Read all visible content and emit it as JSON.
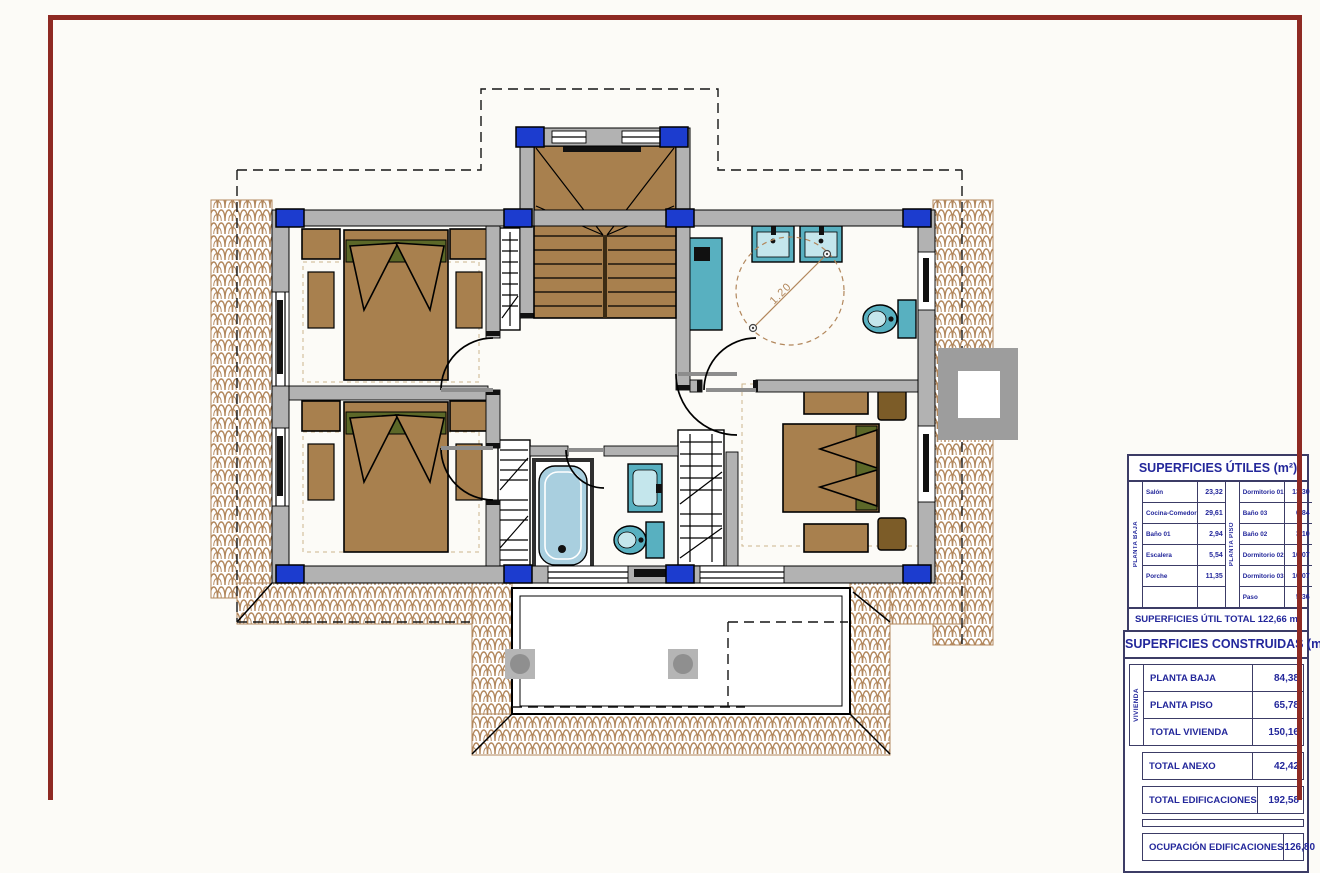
{
  "drawing": {
    "turning_circle_label": "1.20"
  },
  "tables": {
    "utiles": {
      "title": "SUPERFICIES ÚTILES (m²)",
      "groups": [
        {
          "label": "PLANTA BAJA",
          "rows": [
            {
              "name": "Salón",
              "value": "23,32"
            },
            {
              "name": "Cocina-Comedor",
              "value": "29,61"
            },
            {
              "name": "Baño 01",
              "value": "2,94"
            },
            {
              "name": "Escalera",
              "value": "5,54"
            },
            {
              "name": "Porche",
              "value": "11,35"
            },
            {
              "name": "",
              "value": ""
            }
          ]
        },
        {
          "label": "PLANTA PISO",
          "rows": [
            {
              "name": "Dormitorio 01",
              "value": "13,30"
            },
            {
              "name": "Baño 03",
              "value": "6,84"
            },
            {
              "name": "Baño 02",
              "value": "3,10"
            },
            {
              "name": "Dormitorio 02",
              "value": "10,07"
            },
            {
              "name": "Dormitorio 03",
              "value": "10,07"
            },
            {
              "name": "Paso",
              "value": "5,36"
            }
          ]
        }
      ],
      "total": "SUPERFICIES ÚTIL TOTAL 122,66 m²"
    },
    "construidas": {
      "title": "SUPERFICIES CONSTRUIDAS (m²)",
      "group_label": "VIVIENDA",
      "group_rows": [
        {
          "name": "PLANTA BAJA",
          "value": "84,38"
        },
        {
          "name": "PLANTA PISO",
          "value": "65,78"
        },
        {
          "name": "TOTAL VIVIENDA",
          "value": "150,16"
        }
      ],
      "total_rows": [
        {
          "name": "TOTAL ANEXO",
          "value": "42,42"
        },
        {
          "name": "TOTAL EDIFICACIONES",
          "value": "192,58"
        },
        {
          "name": "OCUPACIÓN EDIFICACIONES",
          "value": "126,80"
        }
      ]
    }
  },
  "colors": {
    "frame": "#8e2a23",
    "wall": "#b2b2b2",
    "wood": "#a8804e",
    "darkwood": "#7c5c28",
    "olive": "#5c6828",
    "tile": "#b2875c",
    "fixture": "#58b0c0",
    "tub": "#a9cfdf",
    "column": "#1c3ccf",
    "ttext": "#23279b",
    "tline": "#3c3c66"
  }
}
